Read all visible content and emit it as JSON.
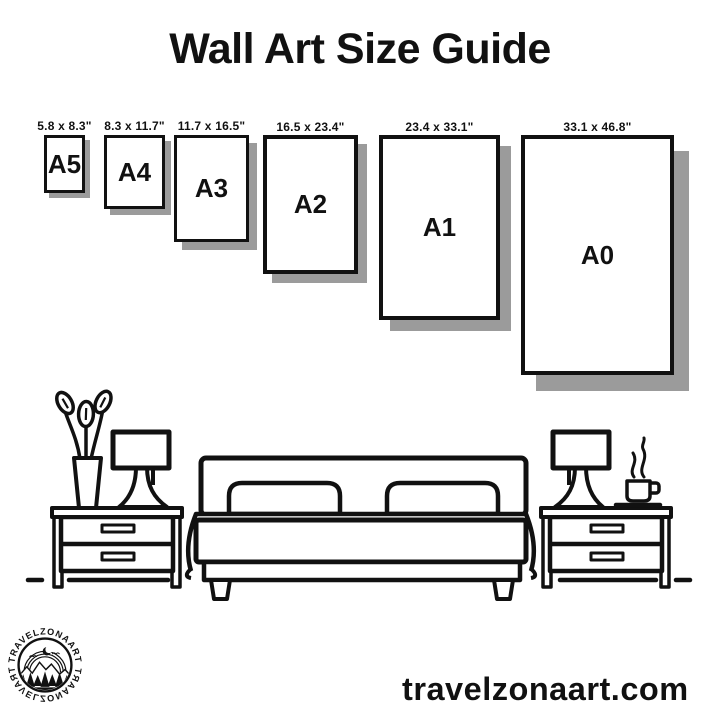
{
  "title": "Wall Art Size Guide",
  "frames": [
    {
      "name": "A5",
      "dims": "5.8 x 8.3\""
    },
    {
      "name": "A4",
      "dims": "8.3 x 11.7\""
    },
    {
      "name": "A3",
      "dims": "11.7 x 16.5\""
    },
    {
      "name": "A2",
      "dims": "16.5 x 23.4\""
    },
    {
      "name": "A1",
      "dims": "23.4 x 33.1\""
    },
    {
      "name": "A0",
      "dims": "33.1 x 46.8\""
    }
  ],
  "illustration": {
    "icons": [
      "plant-icon",
      "table-lamp-icon",
      "nightstand-icon",
      "bed-icon",
      "coffee-cup-icon"
    ]
  },
  "logo": {
    "text": "·TRAVELZONAART·"
  },
  "footer": {
    "website": "travelzonaart.com"
  },
  "colors": {
    "ink": "#111111",
    "shadow": "#9b9b9b",
    "background": "#ffffff"
  }
}
